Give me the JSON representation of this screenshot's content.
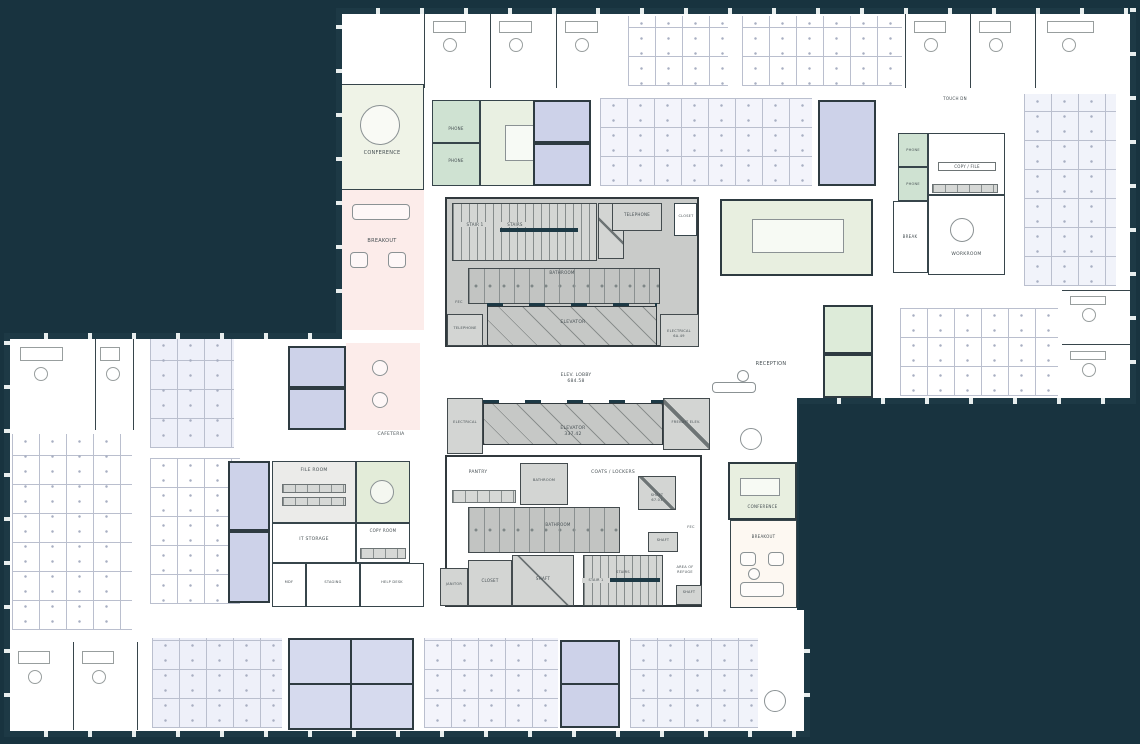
{
  "drawing": {
    "kind": "office-building-floor-plan",
    "colors": {
      "background": "#18333f",
      "plate": "#ffffff",
      "facade_wall": "#1d3945",
      "interior_wall": "#37454b",
      "core_gray": "#c9cbc9",
      "room_blue": "#cdd2e9",
      "zone_blue_light": "#eceef8",
      "room_green": "#cfe2d2",
      "zone_green_light": "#e8efe0",
      "zone_pink": "#fcecea",
      "zone_cream": "#fdf8f2"
    }
  },
  "labels": {
    "conference_tl": "CONFERENCE",
    "breakout_tl": "BREAKOUT",
    "phone_1": "PHONE",
    "phone_2": "PHONE",
    "phone_3": "PHONE",
    "phone_4": "PHONE",
    "touch_dn": "TOUCH DN",
    "copy_file": "COPY / FILE",
    "break_room": "BREAK",
    "workroom": "WORKROOM",
    "stair1_upper": "STAIR 1",
    "stairs_upper": "STAIRS",
    "telephone_upper": "TELEPHONE",
    "closet_upper": "CLOSET",
    "bathroom_upper": "BATHROOM",
    "fec_upper": "FEC",
    "telephone_west": "TELEPHONE",
    "elevator_upper": "ELEVATOR",
    "electrical_upper": "ELECTRICAL",
    "electrical_upper_num": "6A.49",
    "elev_lobby": "ELEV. LOBBY",
    "elev_lobby_num": "684.58",
    "electrical_west": "ELECTRICAL",
    "elevator_lower": "ELEVATOR",
    "elevator_lower_num": "337.42",
    "freight_elev": "FREIGHT ELEV.",
    "pantry": "PANTRY",
    "bathroom_small": "BATHROOM",
    "coats_lockers": "COATS / LOCKERS",
    "shaft_ne": "SHAFT",
    "shaft_ne_num": "67.01",
    "fec_lower": "FEC",
    "bathroom_lower": "BATHROOM",
    "shaft_east": "SHAFT",
    "janitor": "JANITOR",
    "closet_lower": "CLOSET",
    "shaft_large": "SHAFT",
    "stair1_lower": "STAIR 1",
    "stairs_lower": "STAIRS",
    "area_of_refuge_l1": "AREA OF",
    "area_of_refuge_l2": "REFUGE",
    "shaft_se": "SHAFT",
    "reception": "RECEPTION",
    "cafeteria": "CAFETERIA",
    "file_room": "FILE ROOM",
    "it_storage": "IT STORAGE",
    "copy_room": "COPY ROOM",
    "mdf": "MDF",
    "staging": "STAGING",
    "help_desk": "HELP DESK",
    "conference_se": "CONFERENCE",
    "breakout_se": "BREAKOUT"
  }
}
